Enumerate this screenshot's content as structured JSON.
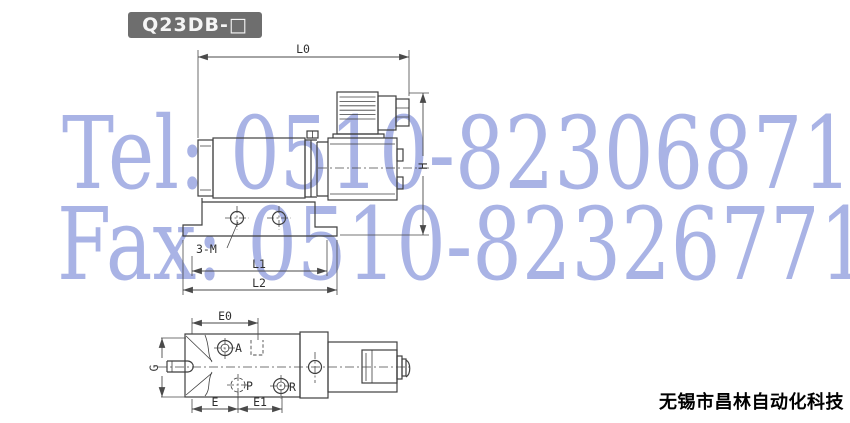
{
  "product_model": "Q23DB-□",
  "company_name": "无锡市昌林自动化科技",
  "watermark": {
    "tel": "Tel: 0510-82306871",
    "fax": "Fax: 0510-82326771",
    "color": "#a9b3e5"
  },
  "drawing": {
    "labels": {
      "L0": "L0",
      "H": "H",
      "mounting_holes": "3-M",
      "L1": "L1",
      "L2": "L2",
      "E0": "E0",
      "G": "G",
      "A": "A",
      "P": "P",
      "R": "R",
      "E": "E",
      "E1": "E1"
    }
  },
  "colors": {
    "badge_background": "#6e6e6e",
    "badge_text": "#f5f5f5",
    "drawing_line": "#3f3f3f",
    "watermark_text": "#a9b3e5",
    "company_text": "#000000",
    "page_background": "#ffffff"
  }
}
